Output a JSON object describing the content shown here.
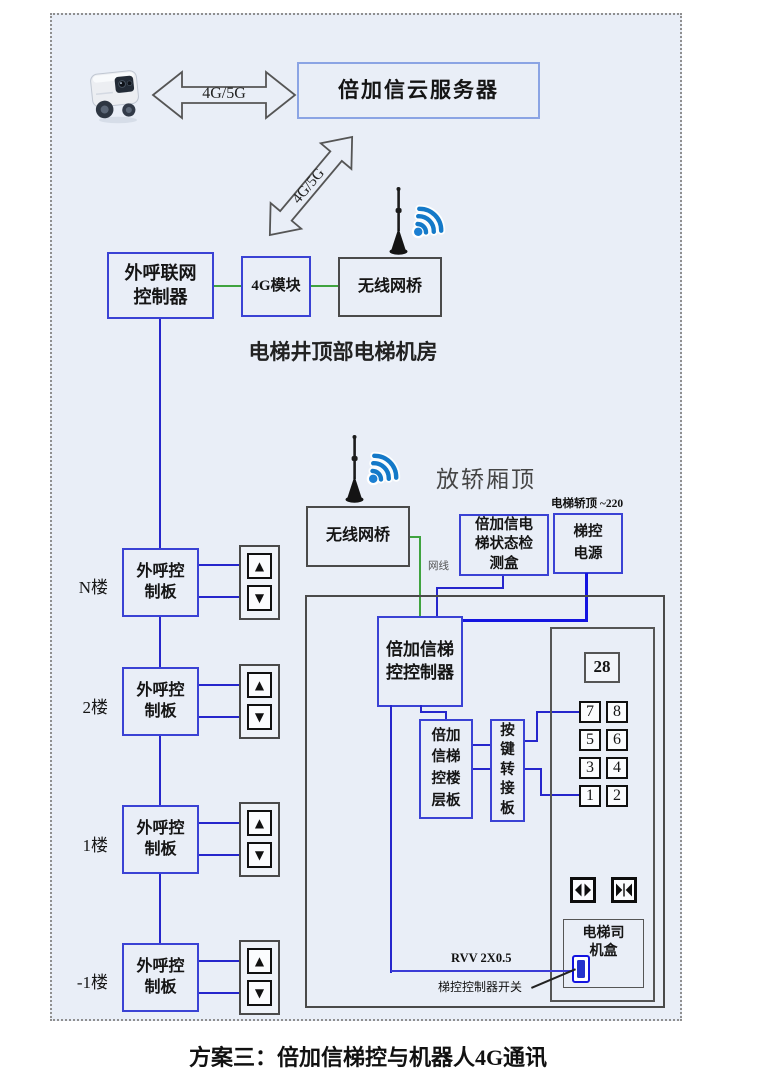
{
  "colors": {
    "background": "#e9eef7",
    "box_blue": "#3a42d4",
    "line_blue": "#2626cc",
    "line_green": "#3fa33f",
    "dark_border": "#4a4a4a",
    "switch_blue": "#1414e0",
    "wifi_blue": "#1479c8"
  },
  "top": {
    "robot_icon": "delivery-robot-icon",
    "link_label": "4G/5G",
    "server_box": "倍加信云服务器",
    "diagonal_link_label": "4G/5G"
  },
  "machine_room": {
    "antenna_icon": "antenna-icon",
    "wifi_icon": "wifi-signal-icon",
    "outcall_controller": "外呼联网控制器",
    "module_4g": "4G模块",
    "wireless_bridge": "无线网桥",
    "caption": "电梯井顶部电梯机房"
  },
  "car_top": {
    "antenna_icon": "antenna-icon",
    "wifi_icon": "wifi-signal-icon",
    "wireless_bridge": "无线网桥",
    "caption": "放轿厢顶",
    "power_note": "电梯轿顶 ~220",
    "cable_label": "网线",
    "status_box": "倍加信电梯状态检测盒",
    "power_box": "梯控电源",
    "elevator_controller": "倍加信梯控控制器",
    "floor_board": "倍加信梯控楼层板",
    "key_adapter_board": "按键转接板",
    "display_value": "28",
    "floor_buttons": [
      "7",
      "8",
      "5",
      "6",
      "3",
      "4",
      "1",
      "2"
    ],
    "door_open_icon": "door-open-icon",
    "door_close_icon": "door-close-icon",
    "driver_box": "电梯司机盒",
    "cable_spec": "RVV 2X0.5",
    "switch_pointer_label": "梯控控制器开关",
    "switch_icon": "toggle-switch-icon"
  },
  "floors": {
    "board_label": "外呼控制板",
    "up_icon": "▲",
    "down_icon": "▼",
    "items": [
      {
        "label": "N楼"
      },
      {
        "label": "2楼"
      },
      {
        "label": "1楼"
      },
      {
        "label": "-1楼"
      }
    ]
  },
  "caption": "方案三：倍加信梯控与机器人4G通讯"
}
